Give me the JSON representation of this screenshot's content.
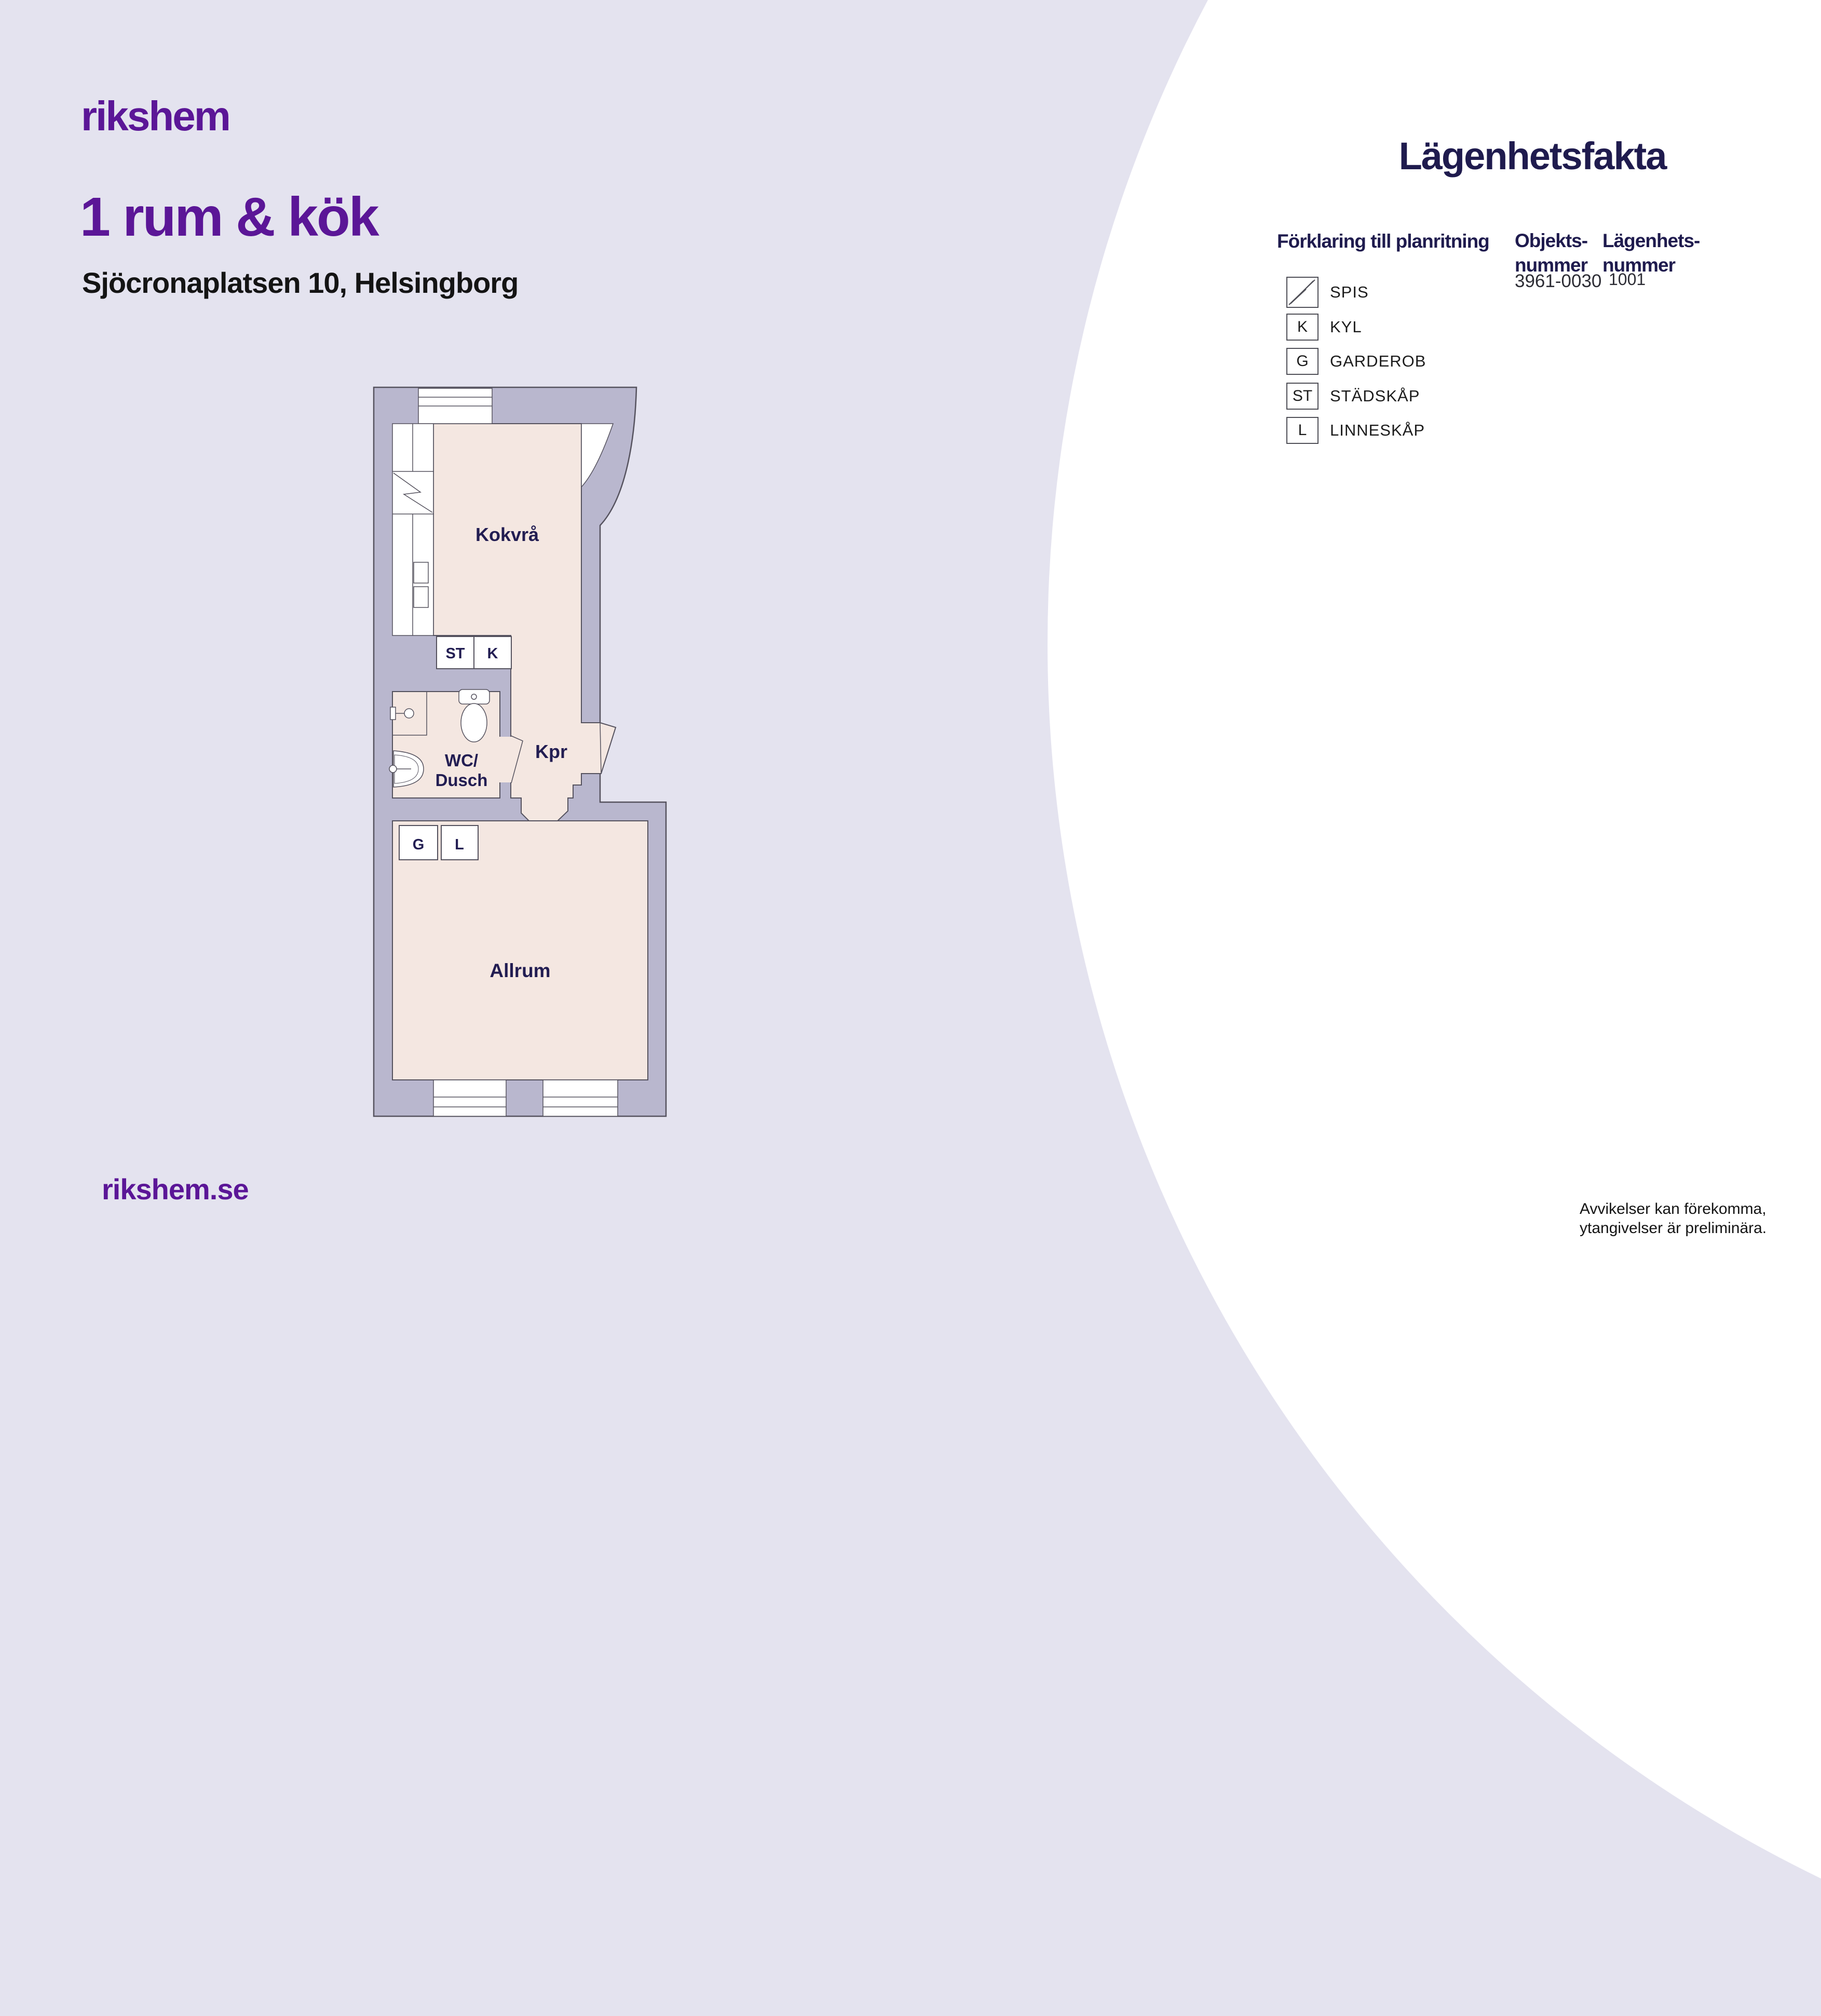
{
  "colors": {
    "background": "#e4e3ef",
    "accent_purple": "#5b1697",
    "navy": "#1f1b4e",
    "wall_gray": "#b9b7ce",
    "room_pink": "#f4e7e1",
    "text_black": "#141414"
  },
  "brand": {
    "logo": "rikshem",
    "website": "rikshem.se"
  },
  "header": {
    "title": "1 rum & kök",
    "address": "Sjöcronaplatsen 10, Helsingborg"
  },
  "facts": {
    "title": "Lägenhetsfakta",
    "legend_title": "Förklaring till planritning",
    "object_number": {
      "label_line1": "Objekts-",
      "label_line2": "nummer",
      "value": "3961-0030"
    },
    "apartment_number": {
      "label_line1": "Lägenhets-",
      "label_line2": "nummer",
      "value": "1001"
    },
    "legend": [
      {
        "symbol": "spis-zigzag",
        "label": "SPIS"
      },
      {
        "symbol": "K",
        "label": "KYL"
      },
      {
        "symbol": "G",
        "label": "GARDEROB"
      },
      {
        "symbol": "ST",
        "label": "STÄDSKÅP"
      },
      {
        "symbol": "L",
        "label": "LINNESKÅP"
      }
    ]
  },
  "floorplan": {
    "rooms": {
      "kitchen": "Kokvrå",
      "hall": "Kpr",
      "bath_line1": "WC/",
      "bath_line2": "Dusch",
      "living": "Allrum"
    },
    "cabinets": {
      "st": "ST",
      "k": "K",
      "g": "G",
      "l": "L"
    }
  },
  "footer": {
    "disclaimer_line1": "Avvikelser kan förekomma,",
    "disclaimer_line2": "ytangivelser är preliminära."
  }
}
